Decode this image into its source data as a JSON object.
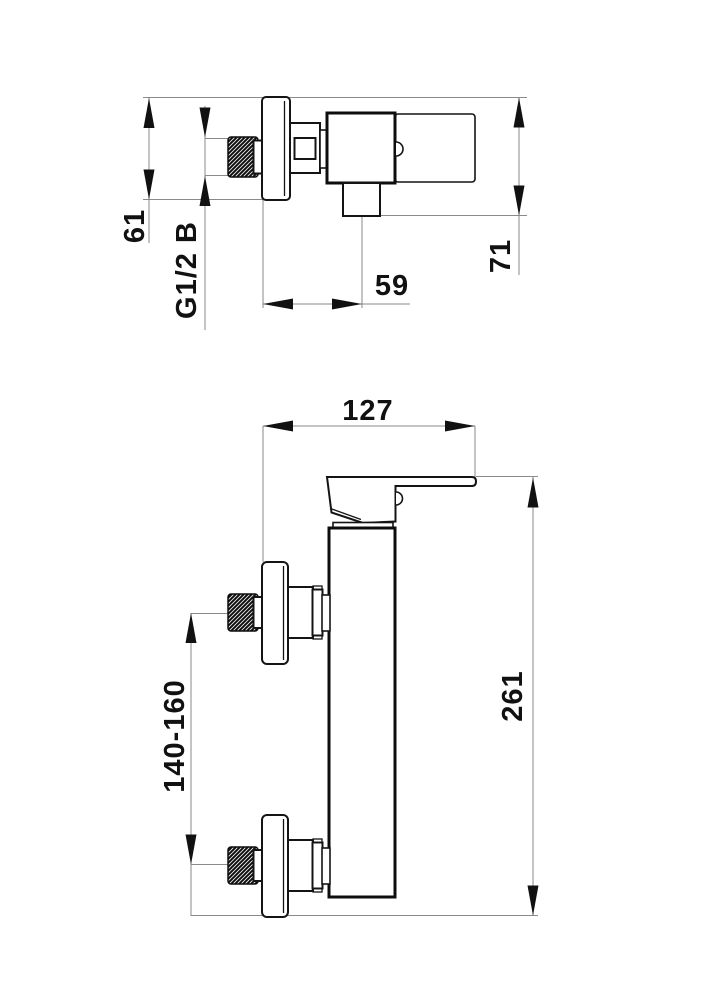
{
  "top_view": {
    "escutcheon_height": "61",
    "thread_size": "G1/2 B",
    "spout_offset": "59",
    "depth": "71"
  },
  "front_view": {
    "width": "127",
    "inlet_spacing": "140-160",
    "overall_height": "261"
  }
}
